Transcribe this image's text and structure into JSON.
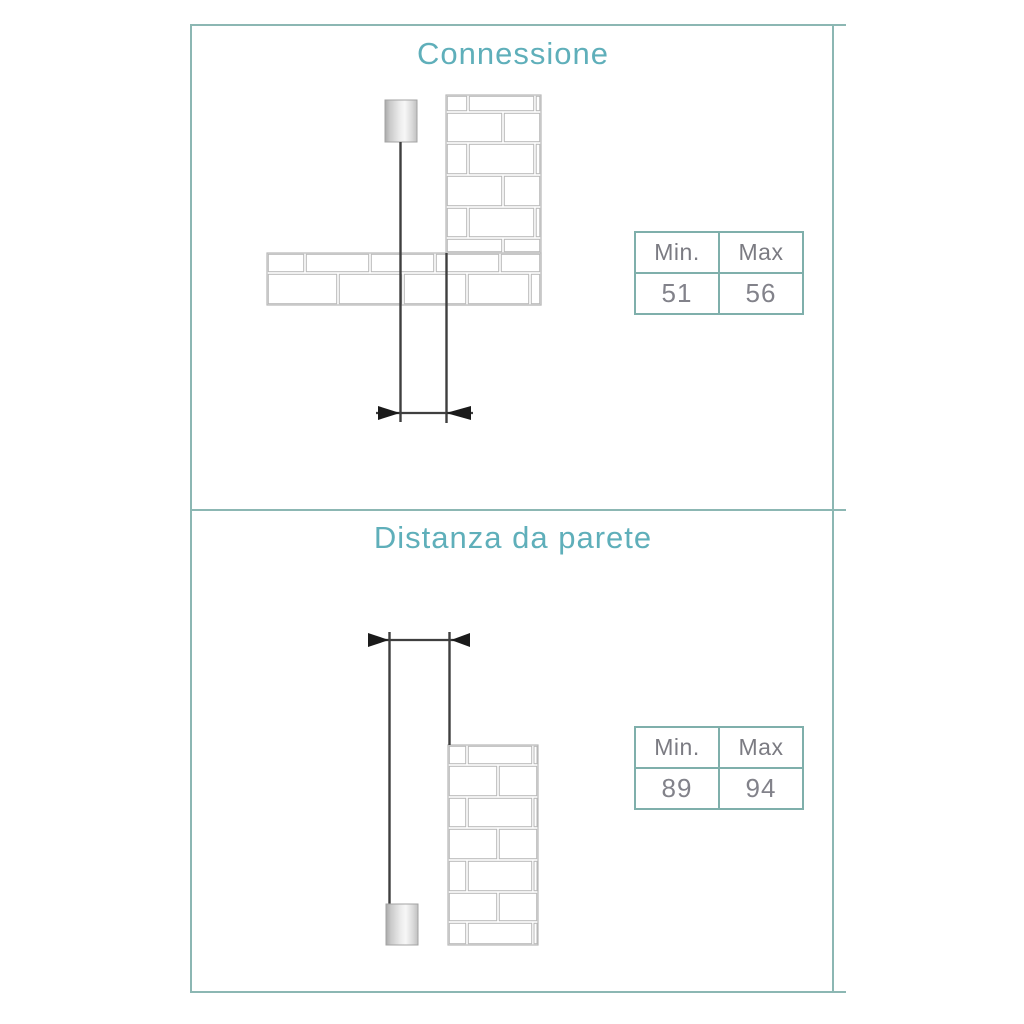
{
  "colors": {
    "background": "#ffffff",
    "panel_border": "#8cb7b3",
    "title_text": "#5fafba",
    "table_border": "#7fafab",
    "header_text": "#7b7b82",
    "value_text": "#82828a",
    "drawing_line": "#3f3f3f",
    "brick_outline": "#b7b7b7",
    "arrow_fill": "#1a1a1a"
  },
  "sections": [
    {
      "title": "Connessione",
      "diagram_icon": "pipe-connection-to-wall-drawing",
      "table": {
        "headers": [
          "Min.",
          "Max"
        ],
        "values": [
          "51",
          "56"
        ]
      }
    },
    {
      "title": "Distanza da parete",
      "diagram_icon": "pipe-distance-from-wall-drawing",
      "table": {
        "headers": [
          "Min.",
          "Max"
        ],
        "values": [
          "89",
          "94"
        ]
      }
    }
  ]
}
